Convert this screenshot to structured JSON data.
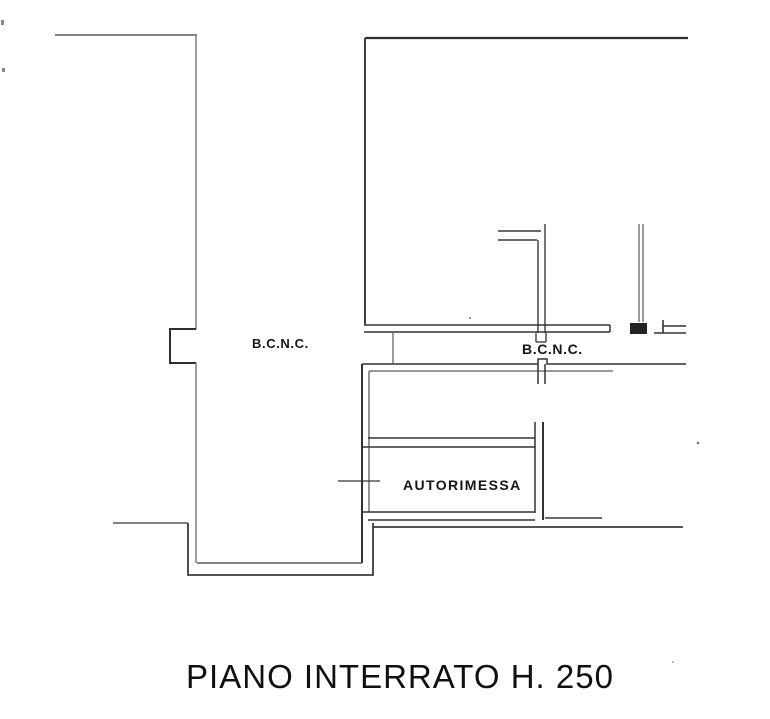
{
  "labels": {
    "bcnc_left": "B.C.N.C.",
    "bcnc_right": "B.C.N.C.",
    "autorimessa": "AUTORIMESSA",
    "title": "PIANO INTERRATO H. 250"
  },
  "colors": {
    "background": "#ffffff",
    "line_dark": "#2f2f2f",
    "line_mid": "#4a4a4a",
    "line_light": "#6e6e6e",
    "text": "#151515"
  }
}
